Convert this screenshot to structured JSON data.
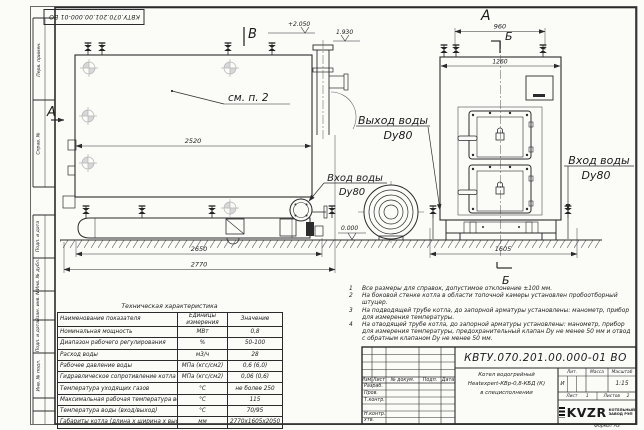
{
  "sheet": {
    "format_label": "Формат  А3",
    "margin_labels": [
      "Перв. примен.",
      "Справ. №",
      "Подп. и дата",
      "Инв. № дубл.",
      "Взам. инв. №",
      "Подп. и дата",
      "Инв. № подл."
    ]
  },
  "drawing": {
    "views": {
      "side_label": "В",
      "side_section": "А",
      "front_label": "А",
      "section": "Б"
    },
    "callouts": {
      "see_item": "см. п. 2",
      "outlet": "Выход воды",
      "inlet": "Вход воды",
      "dn": "Dy80"
    },
    "elevations": {
      "top": "+2.050",
      "pipe": "1.930",
      "zero": "0.000"
    },
    "dims": {
      "d2520": "2520",
      "d2650": "2650",
      "d2770": "2770",
      "d960": "960",
      "d1260": "1260",
      "d1605": "1605"
    }
  },
  "tech_table": {
    "title": "Техническая характеристика",
    "headers": [
      "Наименование показателя",
      "Единицы измерения",
      "Значение"
    ],
    "rows": [
      [
        "Номинальная мощность",
        "МВт",
        "0,8"
      ],
      [
        "Диапазон рабочего регулирования",
        "%",
        "50-100"
      ],
      [
        "Расход воды",
        "м3/ч",
        "28"
      ],
      [
        "Рабочее давление воды",
        "МПа (кгс/см2)",
        "0,6 (6,0)"
      ],
      [
        "Гидравлическое сопротивление котла",
        "МПа (кгс/см2)",
        "0,06 (0,6)"
      ],
      [
        "Температура уходящих газов",
        "°С",
        "не более 250"
      ],
      [
        "Максимальная рабочая температура воды",
        "°С",
        "115"
      ],
      [
        "Температура воды (вход/выход)",
        "°С",
        "70/95"
      ],
      [
        "Габариты котла (длина х ширина х высота)",
        "мм",
        "2770х1605х2050"
      ]
    ]
  },
  "notes": [
    {
      "n": "1",
      "text": "Все размеры для справок, допустимое отклонение ±100 мм."
    },
    {
      "n": "2",
      "text": "На боковой стенке котла в области топочной камеры установлен пробоотборный штуцер."
    },
    {
      "n": "3",
      "text": "На подводящей трубе котла, до запорной арматуры установлены: манометр, прибор для измерения температуры."
    },
    {
      "n": "4",
      "text": "На отводящей трубе котла, до запорной арматуры установлены: манометр, прибор для измерения температуры, предохранительный клапан Dу не менее 50 мм и отвод с обратным клапаном Dу не менее 50 мм."
    }
  ],
  "title_block": {
    "doc_number": "КВТУ.070.201.00.000-01 ВО",
    "change_cols": [
      "Изм.",
      "Лист",
      "№ докум.",
      "Подп.",
      "Дата"
    ],
    "sign_rows": [
      "Разраб.",
      "Пров.",
      "Т.контр.",
      "",
      "Н.контр.",
      "Утв."
    ],
    "product": [
      "Котел водогрейный",
      "Heatexpert-КВр-0,8-КБД (К)",
      "в специсполнении"
    ],
    "lit_label": "Лит.",
    "mass_label": "Масса",
    "scale_label": "Масштаб",
    "lit_value": "И",
    "scale_value": "1:15",
    "sheet_label": "Лист",
    "sheet_value": "1",
    "sheets_label": "Листов",
    "sheets_value": "2",
    "company": {
      "logo": "KVZR",
      "line1": "КОТЕЛЬНЫЙ",
      "line2": "ЗАВОД РЭП"
    }
  }
}
